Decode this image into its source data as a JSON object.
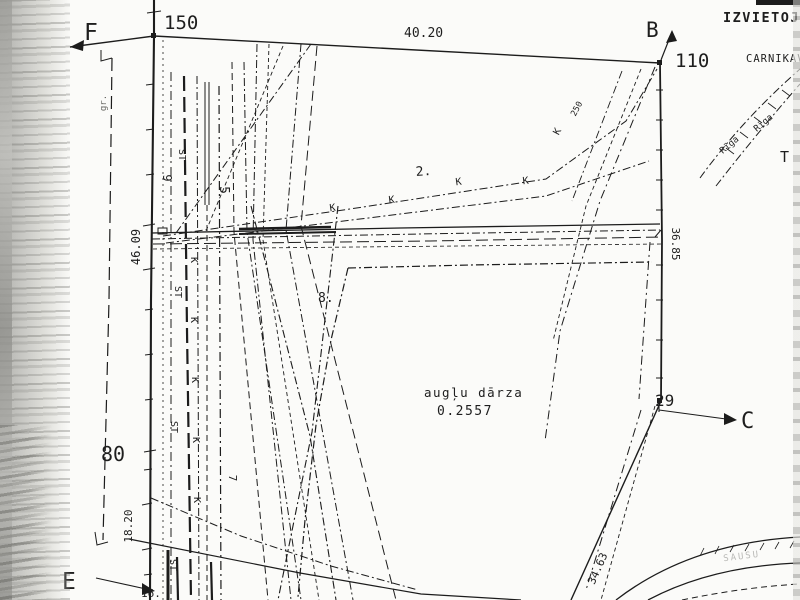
{
  "plan": {
    "corners": {
      "f": "F",
      "b": "B",
      "c": "C",
      "e": "E"
    },
    "stations": {
      "n150": "150",
      "n110": "110",
      "n80": "80",
      "n29": "29"
    },
    "measurements": {
      "top": "40.20",
      "west": "46.09",
      "east": "36.85",
      "west_lower": "18.20",
      "southeast": "34.63"
    },
    "parcel": {
      "number": "8.",
      "name": "augļu dārza",
      "area": "0.2557"
    },
    "line_labels": {
      "n2": "2.",
      "n5": "5",
      "n7": "7",
      "n9": "9",
      "n16": "16."
    },
    "utility": {
      "k": "K",
      "st": "ST",
      "n250": "250",
      "gr": "gr."
    },
    "margin": {
      "title": "IZVIETOJ",
      "subtitle": "CARNIKAV",
      "t": "T",
      "riga": "Rīga",
      "road": "SAUSU"
    }
  },
  "colors": {
    "ink": "#1c1c1c",
    "paper": "#fbfbf9",
    "noise": "#b8b8b4"
  }
}
